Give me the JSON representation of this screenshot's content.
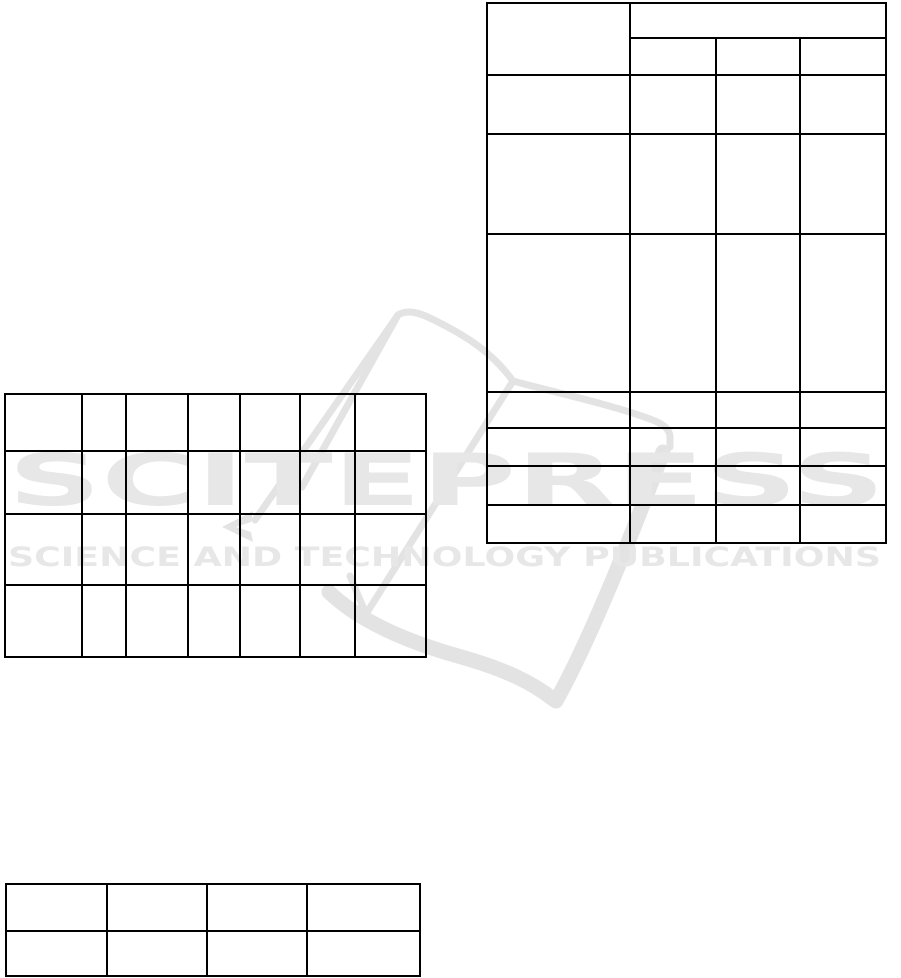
{
  "page": {
    "background": "#ffffff"
  },
  "watermark": {
    "brand": "SCITEPRESS",
    "tagline": "SCIENCE AND TECHNOLOGY PUBLICATIONS",
    "logo_color": "#e3e3e3",
    "text_color": "#e7e7e7"
  },
  "colors": {
    "table_border": "#000000"
  },
  "tables": {
    "top_right": {
      "x": 486,
      "y": 2,
      "col_widths": [
        143,
        86,
        84,
        86
      ],
      "row_heights": [
        35,
        37,
        59,
        100,
        158,
        36,
        38,
        39,
        38
      ],
      "cells": [
        [
          {
            "v": "",
            "rs": 2
          },
          {
            "v": "",
            "cs": 3
          }
        ],
        [
          {
            "v": ""
          },
          {
            "v": ""
          },
          {
            "v": ""
          }
        ],
        [
          {
            "v": ""
          },
          {
            "v": ""
          },
          {
            "v": ""
          },
          {
            "v": ""
          }
        ],
        [
          {
            "v": ""
          },
          {
            "v": ""
          },
          {
            "v": ""
          },
          {
            "v": ""
          }
        ],
        [
          {
            "v": ""
          },
          {
            "v": ""
          },
          {
            "v": ""
          },
          {
            "v": ""
          }
        ],
        [
          {
            "v": ""
          },
          {
            "v": ""
          },
          {
            "v": ""
          },
          {
            "v": ""
          }
        ],
        [
          {
            "v": ""
          },
          {
            "v": ""
          },
          {
            "v": ""
          },
          {
            "v": ""
          }
        ],
        [
          {
            "v": ""
          },
          {
            "v": ""
          },
          {
            "v": ""
          },
          {
            "v": ""
          }
        ],
        [
          {
            "v": ""
          },
          {
            "v": ""
          },
          {
            "v": ""
          },
          {
            "v": ""
          }
        ]
      ]
    },
    "mid_left": {
      "x": 4,
      "y": 393,
      "col_widths": [
        77,
        44,
        62,
        52,
        60,
        55,
        71
      ],
      "row_heights": [
        57,
        63,
        71,
        72
      ],
      "cells": [
        [
          {
            "v": ""
          },
          {
            "v": ""
          },
          {
            "v": ""
          },
          {
            "v": ""
          },
          {
            "v": ""
          },
          {
            "v": ""
          },
          {
            "v": ""
          }
        ],
        [
          {
            "v": ""
          },
          {
            "v": ""
          },
          {
            "v": ""
          },
          {
            "v": ""
          },
          {
            "v": ""
          },
          {
            "v": ""
          },
          {
            "v": ""
          }
        ],
        [
          {
            "v": ""
          },
          {
            "v": ""
          },
          {
            "v": ""
          },
          {
            "v": ""
          },
          {
            "v": ""
          },
          {
            "v": ""
          },
          {
            "v": ""
          }
        ],
        [
          {
            "v": ""
          },
          {
            "v": ""
          },
          {
            "v": ""
          },
          {
            "v": ""
          },
          {
            "v": ""
          },
          {
            "v": ""
          },
          {
            "v": ""
          }
        ]
      ]
    },
    "bottom_left": {
      "x": 5,
      "y": 883,
      "col_widths": [
        101,
        100,
        100,
        113
      ],
      "row_heights": [
        47,
        45
      ],
      "cells": [
        [
          {
            "v": ""
          },
          {
            "v": ""
          },
          {
            "v": ""
          },
          {
            "v": ""
          }
        ],
        [
          {
            "v": ""
          },
          {
            "v": ""
          },
          {
            "v": ""
          },
          {
            "v": ""
          }
        ]
      ]
    }
  }
}
